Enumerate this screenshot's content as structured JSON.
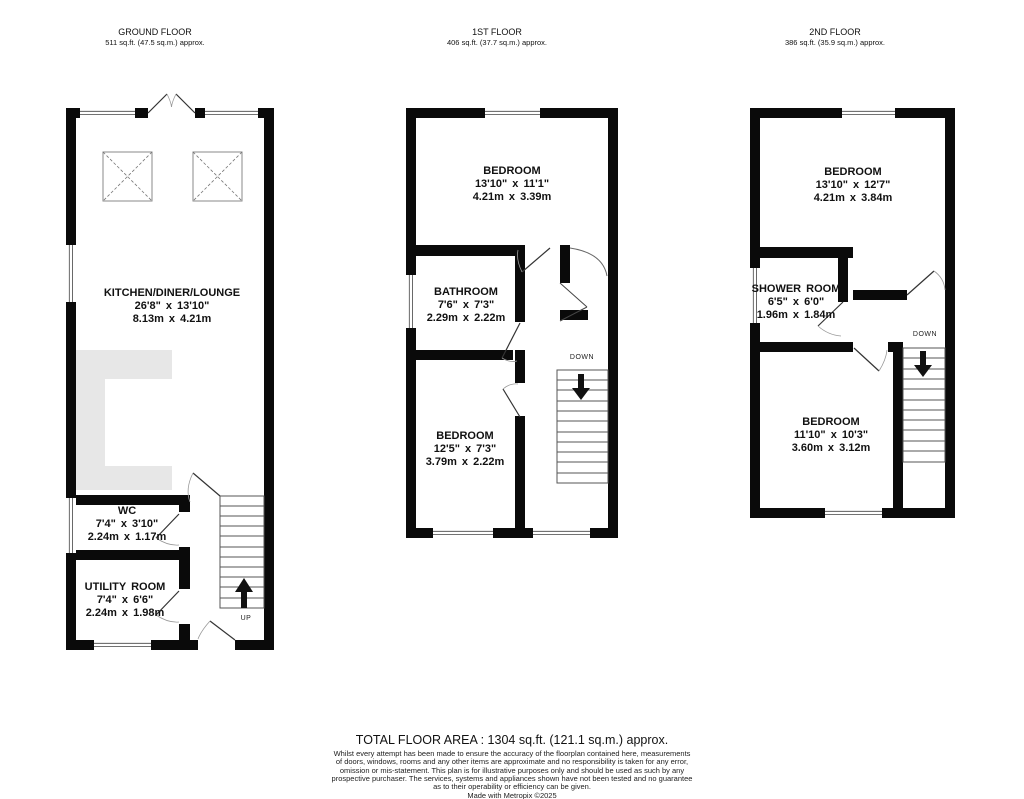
{
  "floors": [
    {
      "title": "GROUND FLOOR",
      "area": "511 sq.ft. (47.5 sq.m.) approx.",
      "rooms": [
        {
          "name": "KITCHEN/DINER/LOUNGE",
          "imperial": "26'8\" x 13'10\"",
          "metric": "8.13m x 4.21m"
        },
        {
          "name": "WC",
          "imperial": "7'4\" x 3'10\"",
          "metric": "2.24m x 1.17m"
        },
        {
          "name": "UTILITY ROOM",
          "imperial": "7'4\" x 6'6\"",
          "metric": "2.24m x 1.98m"
        }
      ],
      "stair_label": "UP"
    },
    {
      "title": "1ST FLOOR",
      "area": "406 sq.ft. (37.7 sq.m.) approx.",
      "rooms": [
        {
          "name": "BEDROOM",
          "imperial": "13'10\" x 11'1\"",
          "metric": "4.21m x 3.39m"
        },
        {
          "name": "BATHROOM",
          "imperial": "7'6\" x 7'3\"",
          "metric": "2.29m x 2.22m"
        },
        {
          "name": "BEDROOM",
          "imperial": "12'5\" x 7'3\"",
          "metric": "3.79m x 2.22m"
        }
      ],
      "stair_label": "DOWN"
    },
    {
      "title": "2ND FLOOR",
      "area": "386 sq.ft. (35.9 sq.m.) approx.",
      "rooms": [
        {
          "name": "BEDROOM",
          "imperial": "13'10\" x 12'7\"",
          "metric": "4.21m x 3.84m"
        },
        {
          "name": "SHOWER ROOM",
          "imperial": "6'5\" x 6'0\"",
          "metric": "1.96m x 1.84m"
        },
        {
          "name": "BEDROOM",
          "imperial": "11'10\" x 10'3\"",
          "metric": "3.60m x 3.12m"
        }
      ],
      "stair_label": "DOWN"
    }
  ],
  "footer": {
    "total": "TOTAL FLOOR AREA : 1304 sq.ft. (121.1 sq.m.) approx.",
    "disclaimer": "Whilst every attempt has been made to ensure the accuracy of the floorplan contained here, measurements\nof doors, windows, rooms and any other items are approximate and no responsibility is taken for any error,\nomission or mis-statement. This plan is for illustrative purposes only and should be used as such by any\nprospective purchaser. The services, systems and appliances shown have not been tested and no guarantee\nas to their operability or efficiency can be given.",
    "made_with": "Made with Metropix ©2025"
  },
  "colors": {
    "wall": "#0a0a0a",
    "counter": "#e7e7e7",
    "background": "#ffffff"
  }
}
